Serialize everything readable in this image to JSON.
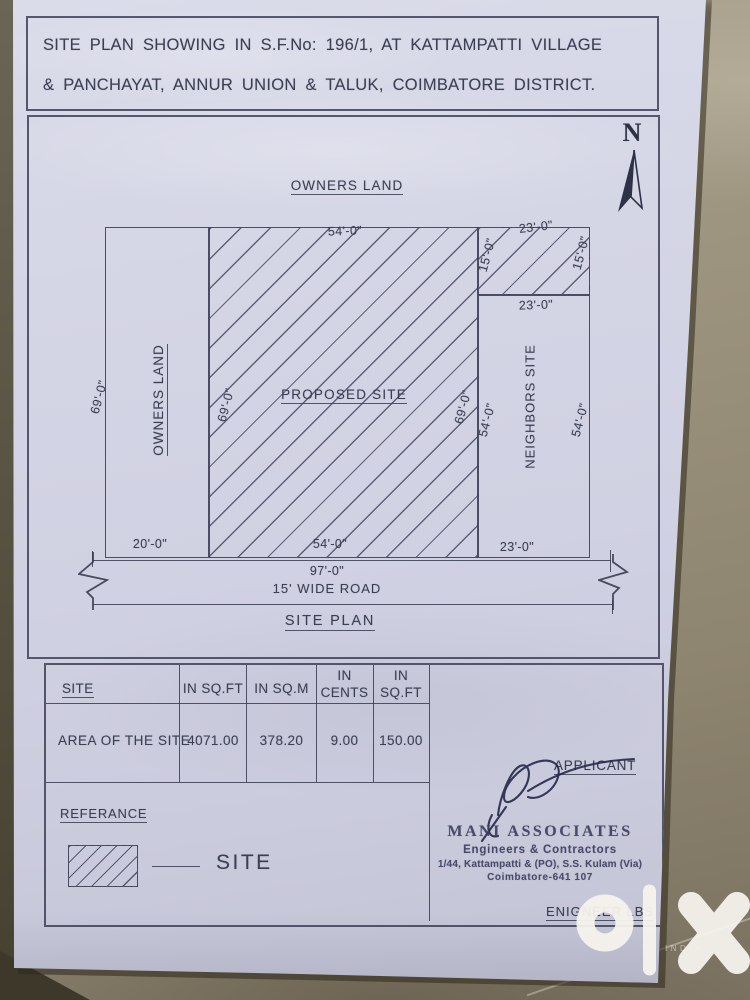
{
  "colors": {
    "ink": "#3b3f54",
    "paper": "#d2d3e3",
    "background": "#998f7c",
    "watermark": "#f7f4ee"
  },
  "title": {
    "line1": "SITE PLAN SHOWING IN S.F.No: 196/1, AT KATTAMPATTI VILLAGE",
    "line2": "& PANCHAYAT, ANNUR UNION & TALUK, COIMBATORE DISTRICT."
  },
  "compass": {
    "north": "N"
  },
  "plan": {
    "owners_land_top": "OWNERS LAND",
    "owners_land_strip": "OWNERS LAND",
    "proposed_site": "PROPOSED SITE",
    "neighbors_site": "NEIGHBORS SITE",
    "road": "15' WIDE ROAD",
    "caption": "SITE PLAN",
    "dims": {
      "top_main": "54'-0\"",
      "top_right": "23'-0\"",
      "ext_left": "15'-0\"",
      "ext_right": "15'-0\"",
      "below_ext": "23'-0\"",
      "left_outer": "69'-0\"",
      "left_inner": "69'-0\"",
      "right_inner": "69'-0\"",
      "neighbors_left": "54'-0\"",
      "neighbors_right": "54'-0\"",
      "bottom_left": "20'-0\"",
      "bottom_main": "54'-0\"",
      "bottom_right": "23'-0\"",
      "total": "97'-0\""
    }
  },
  "area_table": {
    "col_site": "SITE",
    "col_sqft": "IN SQ.FT",
    "col_sqm": "IN SQ.M",
    "col_cents": "IN\nCENTS",
    "col_sqft2": "IN\nSQ.FT",
    "row_label": "AREA OF THE SITE",
    "sqft": "4071.00",
    "sqm": "378.20",
    "cents": "9.00",
    "sqft2": "150.00"
  },
  "signoff": {
    "applicant": "APPLICANT",
    "engineer": "ENIGNEER LBS"
  },
  "reference": {
    "heading": "REFERANCE",
    "legend": "SITE"
  },
  "stamp": {
    "name": "MANI ASSOCIATES",
    "role": "Engineers & Contractors",
    "address1": "1/44, Kattampatti & (PO), S.S. Kulam (Via)",
    "address2": "Coimbatore-641 107"
  },
  "watermark": {
    "brand": "olx",
    "country": "INDIA"
  }
}
